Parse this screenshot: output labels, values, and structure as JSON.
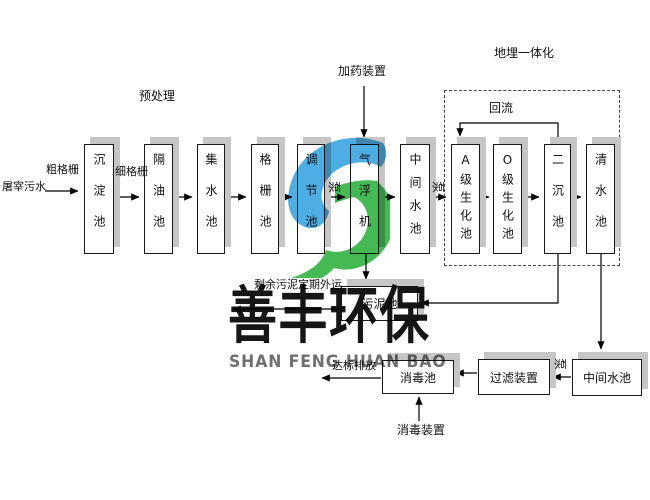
{
  "flow": {
    "influent_label": "屠宰污水",
    "coarse_screen_label": "粗格栅",
    "fine_screen_label": "细格栅",
    "pretreatment_label": "预处理",
    "dosing_label": "加药装置",
    "underground_label": "地埋一体化",
    "reflux_label": "回流",
    "pump_label": "泵",
    "top_row": [
      "沉淀池",
      "隔油池",
      "集水池",
      "格栅池",
      "调节池",
      "气浮机",
      "中间水池",
      "A级生化池",
      "O级生化池",
      "二沉池",
      "清水池"
    ],
    "sludge_tank": "污泥池",
    "excess_sludge_label": "剩余污泥定期外运",
    "bottom_row": [
      "中间水池",
      "过滤装置",
      "消毒池"
    ],
    "discharge_label": "达标排放",
    "disinfection_device_label": "消毒装置"
  },
  "watermark": {
    "title_cn": "善丰环保",
    "title_en": "SHAN FENG HUAN BAO",
    "logo_blue": "#45a9e2",
    "logo_green": "#3bb54a"
  },
  "colors": {
    "box_border": "#1a1a1a",
    "box_shadow": "#c6c6c6",
    "line": "#000000"
  }
}
